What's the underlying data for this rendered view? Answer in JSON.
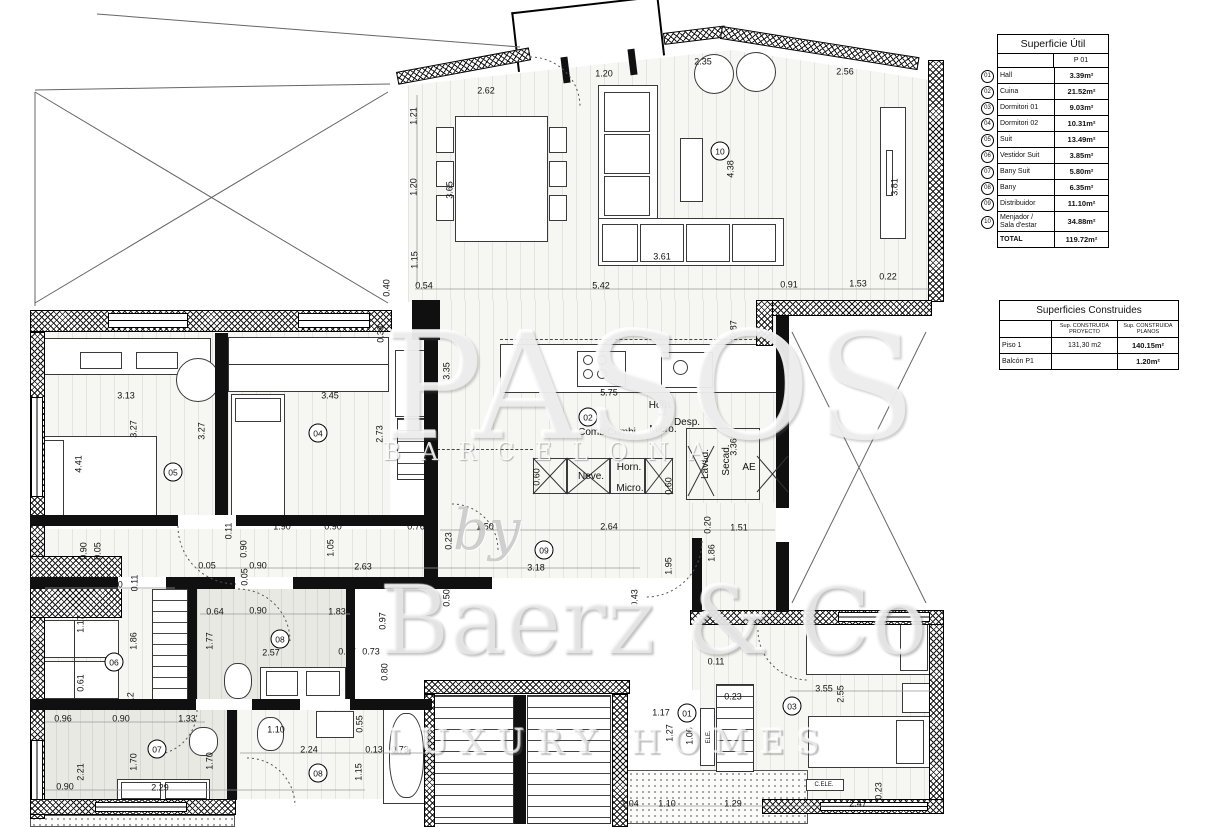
{
  "watermark": {
    "big": "PASOS",
    "band": "BARCELONA",
    "by": "by",
    "brand": "Baerz & Co",
    "tagline": "LUXURY HOMES"
  },
  "tables": {
    "superficie": {
      "title": "Superficie Útil",
      "col": "P 01",
      "rows": [
        [
          "01",
          "Hall",
          "3.39m²"
        ],
        [
          "02",
          "Cuina",
          "21.52m²"
        ],
        [
          "03",
          "Dormitori 01",
          "9.03m²"
        ],
        [
          "04",
          "Dormitori 02",
          "10.31m²"
        ],
        [
          "05",
          "Suit",
          "13.49m²"
        ],
        [
          "06",
          "Vestidor Suit",
          "3.85m²"
        ],
        [
          "07",
          "Bany Suit",
          "5.80m²"
        ],
        [
          "08",
          "Bany",
          "6.35m²"
        ],
        [
          "09",
          "Distribuidor",
          "11.10m²"
        ],
        [
          "10",
          "Menjador /\nSala d'estar",
          "34.88m²"
        ]
      ],
      "total_label": "TOTAL",
      "total_value": "119.72m²"
    },
    "construides": {
      "title": "Superficies Construides",
      "col1": "Sup. CONSTRUIDA\nPROYECTO",
      "col2": "Sup. CONSTRUIDA\nPLANOS",
      "rows": [
        [
          "Piso 1",
          "131,30 m2",
          "140.15m²"
        ],
        [
          "Balcón P1",
          "",
          "1.20m²"
        ]
      ]
    }
  },
  "plan": {
    "room_numbers": [
      [
        "10",
        720,
        151
      ],
      [
        "05",
        173,
        472
      ],
      [
        "04",
        318,
        433
      ],
      [
        "02",
        588,
        417
      ],
      [
        "09",
        544,
        550
      ],
      [
        "06",
        114,
        662
      ],
      [
        "08",
        280,
        639
      ],
      [
        "07",
        157,
        749
      ],
      [
        "08",
        318,
        773
      ],
      [
        "01",
        687,
        713
      ],
      [
        "03",
        792,
        706
      ]
    ],
    "fixture_labels": [
      [
        "Horn.",
        661,
        406,
        0,
        0
      ],
      [
        "CombiCombi",
        607,
        433,
        0,
        0
      ],
      [
        "Micro.",
        663,
        430,
        0,
        0
      ],
      [
        "Desp.",
        687,
        423,
        0,
        0
      ],
      [
        "Neve.",
        591,
        477,
        0,
        0
      ],
      [
        "Horn.",
        629,
        468,
        0,
        0
      ],
      [
        "Micro.",
        630,
        489,
        0,
        0
      ],
      [
        "Lavad.",
        706,
        464,
        1,
        0
      ],
      [
        "Secad.",
        727,
        460,
        1,
        0
      ],
      [
        "AE",
        749,
        468,
        0,
        0
      ],
      [
        "ELE.",
        709,
        737,
        1,
        1
      ],
      [
        "C.ELE.",
        824,
        785,
        0,
        1
      ]
    ],
    "dimensions": [
      [
        "2.62",
        486,
        91,
        0
      ],
      [
        "1.20",
        604,
        74,
        0
      ],
      [
        "2.35",
        703,
        62,
        0
      ],
      [
        "2.56",
        845,
        72,
        0
      ],
      [
        "1.21",
        414,
        116,
        1
      ],
      [
        "1.20",
        414,
        187,
        1
      ],
      [
        "1.15",
        415,
        260,
        1
      ],
      [
        "0.40",
        387,
        288,
        1
      ],
      [
        "0.54",
        424,
        286,
        0
      ],
      [
        "5.42",
        601,
        286,
        0
      ],
      [
        "3.61",
        662,
        257,
        0
      ],
      [
        "0.91",
        789,
        285,
        0
      ],
      [
        "1.53",
        858,
        284,
        0
      ],
      [
        "0.22",
        888,
        277,
        0
      ],
      [
        "4.38",
        731,
        169,
        1
      ],
      [
        "3.81",
        895,
        187,
        1
      ],
      [
        "3.65",
        450,
        190,
        1
      ],
      [
        "0.33",
        381,
        334,
        1
      ],
      [
        "3.35",
        447,
        371,
        1
      ],
      [
        "2.73",
        380,
        434,
        1
      ],
      [
        "0.87",
        734,
        329,
        1
      ],
      [
        "5.75",
        609,
        393,
        0
      ],
      [
        "1.28",
        663,
        408,
        1
      ],
      [
        "3.36",
        734,
        447,
        1
      ],
      [
        "0.60",
        537,
        477,
        1
      ],
      [
        "0.60",
        669,
        486,
        1
      ],
      [
        "3.13",
        126,
        396,
        0
      ],
      [
        "3.45",
        330,
        396,
        0
      ],
      [
        "3.27",
        134,
        429,
        1
      ],
      [
        "3.27",
        202,
        431,
        1
      ],
      [
        "4.41",
        79,
        464,
        1
      ],
      [
        "1.90",
        282,
        527,
        0
      ],
      [
        "0.90",
        333,
        527,
        0
      ],
      [
        "0.76",
        416,
        527,
        0
      ],
      [
        "0.11",
        229,
        531,
        1
      ],
      [
        "0.90",
        244,
        549,
        1
      ],
      [
        "1.05",
        331,
        548,
        1
      ],
      [
        "0.90",
        84,
        551,
        1
      ],
      [
        "0.05",
        98,
        551,
        1
      ],
      [
        "0.05",
        207,
        566,
        0
      ],
      [
        "0.90",
        258,
        566,
        0
      ],
      [
        "2.63",
        363,
        567,
        0
      ],
      [
        "0.05",
        245,
        577,
        1
      ],
      [
        "0.63",
        58,
        585,
        0
      ],
      [
        "1.30",
        114,
        585,
        0
      ],
      [
        "0.11",
        135,
        583,
        1
      ],
      [
        "1.17",
        81,
        624,
        1
      ],
      [
        "1.86",
        134,
        641,
        1
      ],
      [
        "0.61",
        81,
        683,
        1
      ],
      [
        "0.64",
        215,
        612,
        0
      ],
      [
        "0.90",
        258,
        611,
        0
      ],
      [
        "1.83",
        337,
        612,
        0
      ],
      [
        "1.77",
        210,
        641,
        1
      ],
      [
        "2.57",
        271,
        653,
        0
      ],
      [
        "0.07",
        347,
        652,
        0
      ],
      [
        "0.73",
        371,
        652,
        0
      ],
      [
        "0.97",
        383,
        621,
        1
      ],
      [
        "0.80",
        385,
        672,
        1
      ],
      [
        "0.23",
        449,
        541,
        1
      ],
      [
        "1.50",
        485,
        527,
        0
      ],
      [
        "2.64",
        609,
        527,
        0
      ],
      [
        "0.20",
        708,
        525,
        1
      ],
      [
        "1.51",
        739,
        528,
        0
      ],
      [
        "3.18",
        536,
        568,
        0
      ],
      [
        "1.95",
        669,
        566,
        1
      ],
      [
        "1.86",
        712,
        553,
        1
      ],
      [
        "0.43",
        635,
        598,
        1
      ],
      [
        "0.50",
        447,
        598,
        1
      ],
      [
        "0.96",
        63,
        719,
        0
      ],
      [
        "0.90",
        121,
        719,
        0
      ],
      [
        "1.33",
        187,
        719,
        0
      ],
      [
        "0.12",
        131,
        701,
        1
      ],
      [
        "2.21",
        81,
        772,
        1
      ],
      [
        "1.70",
        134,
        762,
        1
      ],
      [
        "1.70",
        210,
        761,
        1
      ],
      [
        "0.90",
        65,
        787,
        0
      ],
      [
        "2.29",
        160,
        788,
        0
      ],
      [
        "1.10",
        276,
        730,
        0
      ],
      [
        "0.55",
        360,
        724,
        1
      ],
      [
        "2.24",
        309,
        750,
        0
      ],
      [
        "0.13",
        374,
        750,
        0
      ],
      [
        "0.73",
        400,
        750,
        0
      ],
      [
        "1.15",
        359,
        772,
        1
      ],
      [
        "0.11",
        716,
        662,
        0
      ],
      [
        "0.23",
        733,
        697,
        0
      ],
      [
        "1.17",
        661,
        713,
        0
      ],
      [
        "1.27",
        670,
        733,
        1
      ],
      [
        "1.06",
        690,
        736,
        1
      ],
      [
        "3.55",
        824,
        689,
        0
      ],
      [
        "2.55",
        841,
        694,
        1
      ],
      [
        "2.47",
        858,
        804,
        0
      ],
      [
        "0.23",
        879,
        791,
        1
      ],
      [
        "1.04",
        630,
        804,
        0
      ],
      [
        "1.10",
        667,
        804,
        0
      ],
      [
        "1.29",
        733,
        804,
        0
      ]
    ]
  }
}
